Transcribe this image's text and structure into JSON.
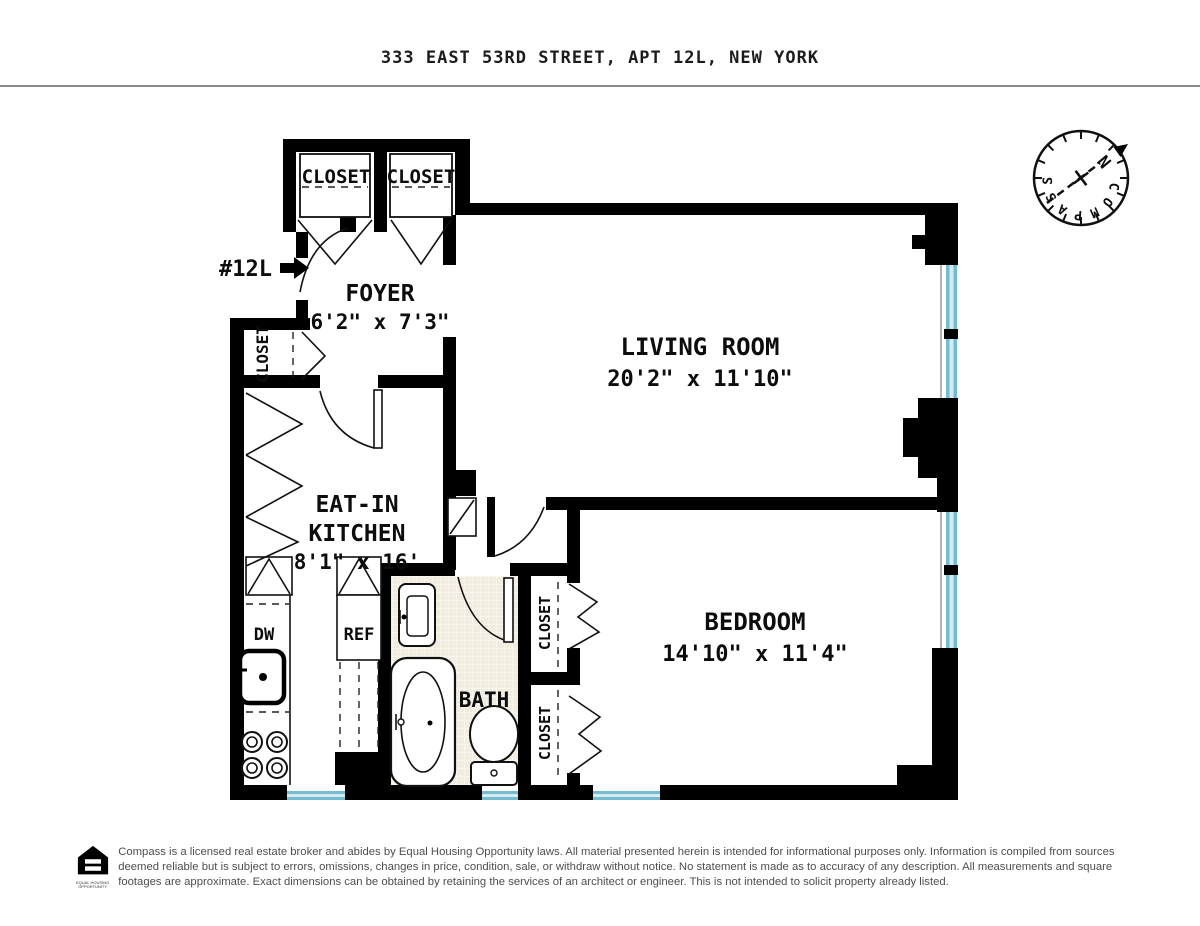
{
  "header": {
    "title": "333 EAST 53RD STREET, APT 12L, NEW YORK"
  },
  "compass": {
    "label": "COMPASS",
    "north_label": "N"
  },
  "entry": {
    "unit_label": "#12L"
  },
  "rooms": {
    "foyer": {
      "name": "FOYER",
      "dimensions": "6'2\" x 7'3\""
    },
    "living_room": {
      "name": "LIVING ROOM",
      "dimensions": "20'2\" x 11'10\""
    },
    "eat_in_kitchen": {
      "name_line1": "EAT-IN",
      "name_line2": "KITCHEN",
      "dimensions": "8'1\" x 16'"
    },
    "bedroom": {
      "name": "BEDROOM",
      "dimensions": "14'10\" x 11'4\""
    },
    "bath": {
      "name": "BATH"
    }
  },
  "closets": {
    "hall_closet_1": "CLOSET",
    "hall_closet_2": "CLOSET",
    "foyer_closet": "CLOSET",
    "bedroom_closet_1": "CLOSET",
    "bedroom_closet_2": "CLOSET"
  },
  "appliances": {
    "dishwasher": "DW",
    "refrigerator": "REF"
  },
  "footer": {
    "logo_caption_line1": "EQUAL HOUSING",
    "logo_caption_line2": "OPPORTUNITY",
    "disclaimer": "Compass is a licensed real estate broker and abides by Equal Housing Opportunity laws. All material presented herein is intended for informational purposes only. Information is compiled from sources deemed reliable but is subject to errors, omissions, changes in price, condition, sale, or withdraw without notice. No statement is made as to accuracy of any description. All measurements and square footages are approximate. Exact dimensions can be obtained by retaining the services of an architect or engineer. This is not intended to solicit property already listed."
  },
  "colors": {
    "wall": "#000000",
    "window_teal": "#74bdd1",
    "window_light": "#d5eaf1",
    "tile": "#f2ede1",
    "north_red": "#c8281c"
  }
}
